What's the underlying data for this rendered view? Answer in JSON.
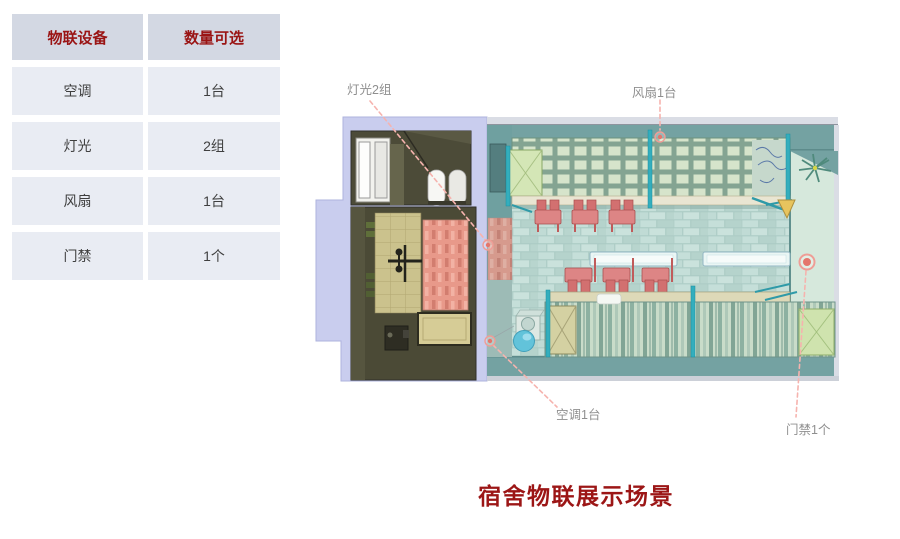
{
  "table": {
    "headers": [
      "物联设备",
      "数量可选"
    ],
    "rows": [
      {
        "device": "空调",
        "qty": "1台"
      },
      {
        "device": "灯光",
        "qty": "2组"
      },
      {
        "device": "风扇",
        "qty": "1台"
      },
      {
        "device": "门禁",
        "qty": "1个"
      }
    ]
  },
  "scene": {
    "title": "宿舍物联展示场景",
    "callouts": [
      {
        "id": "light",
        "label": "灯光2组"
      },
      {
        "id": "fan",
        "label": "风扇1台"
      },
      {
        "id": "ac",
        "label": "空调1台"
      },
      {
        "id": "door",
        "label": "门禁1个"
      }
    ]
  },
  "colors": {
    "header_bg": "#d3d8e3",
    "row_bg": "#e9ecf3",
    "heading_red": "#9a1414",
    "title_red": "#9c1616",
    "label_gray": "#8f8f8f",
    "callout_line": "#f6b3ae",
    "marker_red": "#e4766c",
    "wall_lavender": "#c9cdee",
    "room_wall_teal": "#74a2a2",
    "floor_teal": "#b9d6d0",
    "entry_green": "#d6e8dc",
    "chair_red": "#dd8585"
  }
}
